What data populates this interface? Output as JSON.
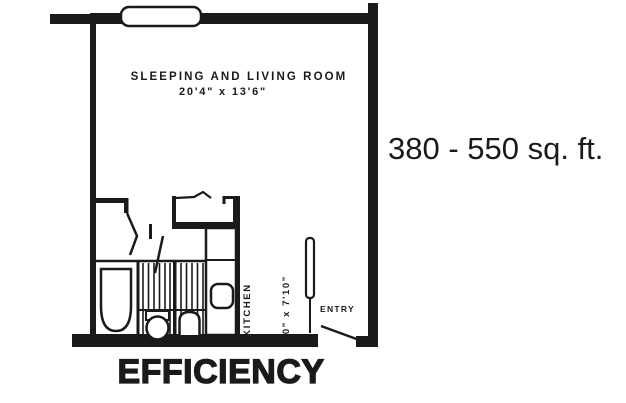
{
  "floor_plan": {
    "title": "EFFICIENCY",
    "area_range": "380 - 550 sq. ft.",
    "main_room": {
      "name": "SLEEPING AND LIVING ROOM",
      "dimensions": "20'4\" x 13'6\""
    },
    "kitchen": {
      "name": "KITCHEN",
      "dimensions": "8'0\" x 7'10\""
    },
    "entry_label": "ENTRY",
    "colors": {
      "ink": "#1a1a1a",
      "background": "#ffffff"
    },
    "fixture_icons": [
      "window-icon",
      "bathtub-icon",
      "toilet-icon",
      "bathroom-sink-icon",
      "kitchen-sink-icon",
      "kitchen-counter-icon",
      "closet-bifold-door-icon",
      "entry-door-icon",
      "door-swing-icon"
    ]
  }
}
